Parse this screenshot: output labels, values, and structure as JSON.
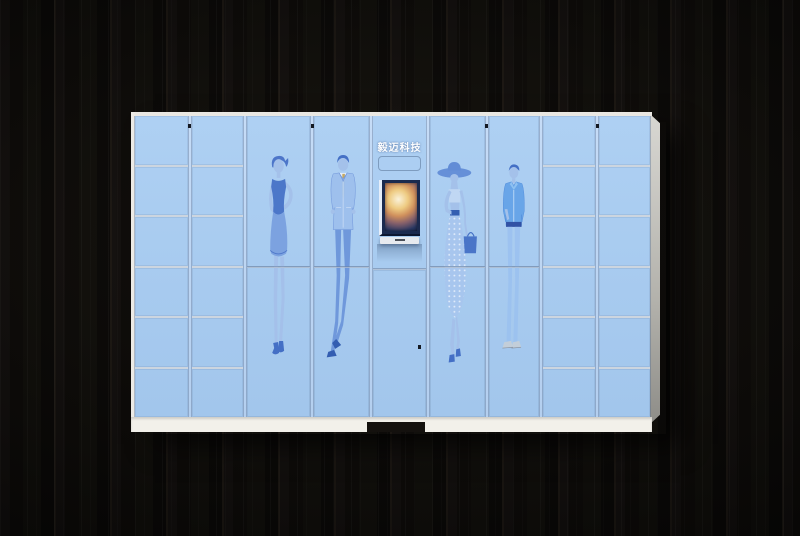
{
  "scene": {
    "description": "Smart parcel locker cabinet photographed against a dark wood plank wall",
    "wall_color": "#0b0a08"
  },
  "cabinet": {
    "brand_label": "毅迈科技",
    "body_color": "#a7caf1",
    "frame_color": "#bdd6f4",
    "edge_color": "#ebe9e4",
    "base_color": "#f2f0ea",
    "divider_color": "#ccd5df",
    "screen_frame_color": "#1b2a4e",
    "artwork_style": "light-blue fashion sketch figures printed across the tall doors",
    "columns": [
      {
        "type": "small-lockers",
        "rows": 6,
        "w": 52,
        "lock_right": true
      },
      {
        "type": "small-lockers",
        "rows": 6,
        "w": 50
      },
      {
        "type": "tall-doors",
        "figure": "woman-dress",
        "w": 63,
        "lock_right": true
      },
      {
        "type": "tall-doors",
        "figure": "man-suit",
        "w": 54
      },
      {
        "type": "kiosk",
        "w": 52
      },
      {
        "type": "tall-doors",
        "figure": "woman-hat",
        "w": 54,
        "lock_right": true
      },
      {
        "type": "tall-doors",
        "figure": "man-casual",
        "w": 49
      },
      {
        "type": "small-lockers",
        "rows": 6,
        "w": 52,
        "lock_right": true
      },
      {
        "type": "small-lockers",
        "rows": 6,
        "w": 50
      }
    ],
    "figures": {
      "woman-dress": "fashion sketch — woman in sleeveless dark-blue dress, hand on hip, high heels",
      "man-suit": "fashion sketch — man in light-blue suit with gold tie, ankles crossed",
      "woman-hat": "fashion sketch — woman in wide-brim hat, polka-dot long skirt, dark-blue handbag",
      "man-casual": "fashion sketch — man in casual blue jacket and jeans, hand in pocket"
    },
    "kiosk": {
      "screen_content": "bright photo shown on the touchscreen display",
      "has_reader_panel": true,
      "has_keyboard_ledge": true,
      "lower_door_lock": true
    }
  }
}
